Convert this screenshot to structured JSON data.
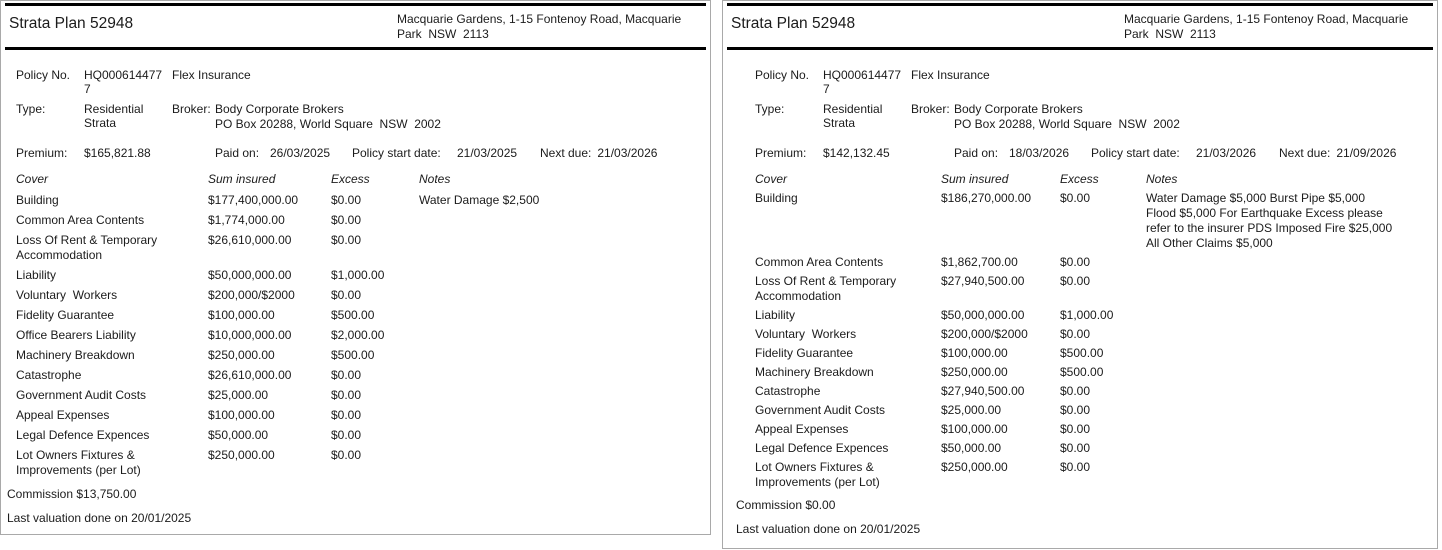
{
  "colors": {
    "rule": "#000000",
    "panel_border": "#a9a9a9",
    "text": "#1b1b1b",
    "background": "#ffffff"
  },
  "panels": [
    {
      "title": "Strata Plan 52948",
      "address": "Macquarie Gardens, 1-15 Fontenoy Road, Macquarie Park  NSW  2113",
      "labels": {
        "policy_no": "Policy No.",
        "type": "Type:",
        "broker": "Broker:",
        "premium": "Premium:",
        "paid_on": "Paid on:",
        "policy_start": "Policy start date:",
        "next_due": "Next due:"
      },
      "policy_no": "HQ0006144777",
      "insurer": "Flex Insurance",
      "type": "Residential Strata",
      "broker_name": "Body Corporate Brokers",
      "broker_address": "PO Box 20288, World Square  NSW  2002",
      "premium": "$165,821.88",
      "paid_on": "26/03/2025",
      "policy_start": "21/03/2025",
      "next_due": "21/03/2026",
      "table": {
        "headers": {
          "cover": "Cover",
          "sum": "Sum insured",
          "excess": "Excess",
          "notes": "Notes"
        },
        "rows": [
          {
            "cover": "Building",
            "sum": "$177,400,000.00",
            "excess": "$0.00",
            "notes": "Water Damage $2,500"
          },
          {
            "cover": "Common Area Contents",
            "sum": "$1,774,000.00",
            "excess": "$0.00",
            "notes": ""
          },
          {
            "cover": "Loss Of Rent & Temporary Accommodation",
            "sum": "$26,610,000.00",
            "excess": "$0.00",
            "notes": ""
          },
          {
            "cover": "Liability",
            "sum": "$50,000,000.00",
            "excess": "$1,000.00",
            "notes": ""
          },
          {
            "cover": "Voluntary  Workers",
            "sum": "$200,000/$2000",
            "excess": "$0.00",
            "notes": ""
          },
          {
            "cover": "Fidelity Guarantee",
            "sum": "$100,000.00",
            "excess": "$500.00",
            "notes": ""
          },
          {
            "cover": "Office Bearers Liability",
            "sum": "$10,000,000.00",
            "excess": "$2,000.00",
            "notes": ""
          },
          {
            "cover": "Machinery Breakdown",
            "sum": "$250,000.00",
            "excess": "$500.00",
            "notes": ""
          },
          {
            "cover": "Catastrophe",
            "sum": "$26,610,000.00",
            "excess": "$0.00",
            "notes": ""
          },
          {
            "cover": "Government Audit Costs",
            "sum": "$25,000.00",
            "excess": "$0.00",
            "notes": ""
          },
          {
            "cover": "Appeal Expenses",
            "sum": "$100,000.00",
            "excess": "$0.00",
            "notes": ""
          },
          {
            "cover": "Legal Defence Expences",
            "sum": "$50,000.00",
            "excess": "$0.00",
            "notes": ""
          },
          {
            "cover": "Lot Owners Fixtures & Improvements (per Lot)",
            "sum": "$250,000.00",
            "excess": "$0.00",
            "notes": ""
          }
        ]
      },
      "commission": "Commission $13,750.00",
      "last_valuation": "Last valuation done on 20/01/2025",
      "insurance_valuation": "Insurance valuation $177,400,000.00"
    },
    {
      "title": "Strata Plan 52948",
      "address": "Macquarie Gardens, 1-15 Fontenoy Road, Macquarie Park  NSW  2113",
      "labels": {
        "policy_no": "Policy No.",
        "type": "Type:",
        "broker": "Broker:",
        "premium": "Premium:",
        "paid_on": "Paid on:",
        "policy_start": "Policy start date:",
        "next_due": "Next due:"
      },
      "policy_no": "HQ0006144777",
      "insurer": "Flex Insurance",
      "type": "Residential Strata",
      "broker_name": "Body Corporate Brokers",
      "broker_address": "PO Box 20288, World Square  NSW  2002",
      "premium": "$142,132.45",
      "paid_on": "18/03/2026",
      "policy_start": "21/03/2026",
      "next_due": "21/09/2026",
      "table": {
        "headers": {
          "cover": "Cover",
          "sum": "Sum insured",
          "excess": "Excess",
          "notes": "Notes"
        },
        "rows": [
          {
            "cover": "Building",
            "sum": "$186,270,000.00",
            "excess": "$0.00",
            "notes": "Water Damage $5,000 Burst Pipe $5,000 Flood $5,000 For Earthquake Excess please refer to the insurer PDS Imposed Fire $25,000 All Other Claims $5,000"
          },
          {
            "cover": "Common Area Contents",
            "sum": "$1,862,700.00",
            "excess": "$0.00",
            "notes": ""
          },
          {
            "cover": "Loss Of Rent & Temporary Accommodation",
            "sum": "$27,940,500.00",
            "excess": "$0.00",
            "notes": ""
          },
          {
            "cover": "Liability",
            "sum": "$50,000,000.00",
            "excess": "$1,000.00",
            "notes": ""
          },
          {
            "cover": "Voluntary  Workers",
            "sum": "$200,000/$2000",
            "excess": "$0.00",
            "notes": ""
          },
          {
            "cover": "Fidelity Guarantee",
            "sum": "$100,000.00",
            "excess": "$500.00",
            "notes": ""
          },
          {
            "cover": "Machinery Breakdown",
            "sum": "$250,000.00",
            "excess": "$500.00",
            "notes": ""
          },
          {
            "cover": "Catastrophe",
            "sum": "$27,940,500.00",
            "excess": "$0.00",
            "notes": ""
          },
          {
            "cover": "Government Audit Costs",
            "sum": "$25,000.00",
            "excess": "$0.00",
            "notes": ""
          },
          {
            "cover": "Appeal Expenses",
            "sum": "$100,000.00",
            "excess": "$0.00",
            "notes": ""
          },
          {
            "cover": "Legal Defence Expences",
            "sum": "$50,000.00",
            "excess": "$0.00",
            "notes": ""
          },
          {
            "cover": "Lot Owners Fixtures & Improvements (per Lot)",
            "sum": "$250,000.00",
            "excess": "$0.00",
            "notes": ""
          }
        ]
      },
      "commission": "Commission $0.00",
      "last_valuation": "Last valuation done on 20/01/2025",
      "insurance_valuation": "Insurance valuation $177,400,000.00"
    }
  ]
}
